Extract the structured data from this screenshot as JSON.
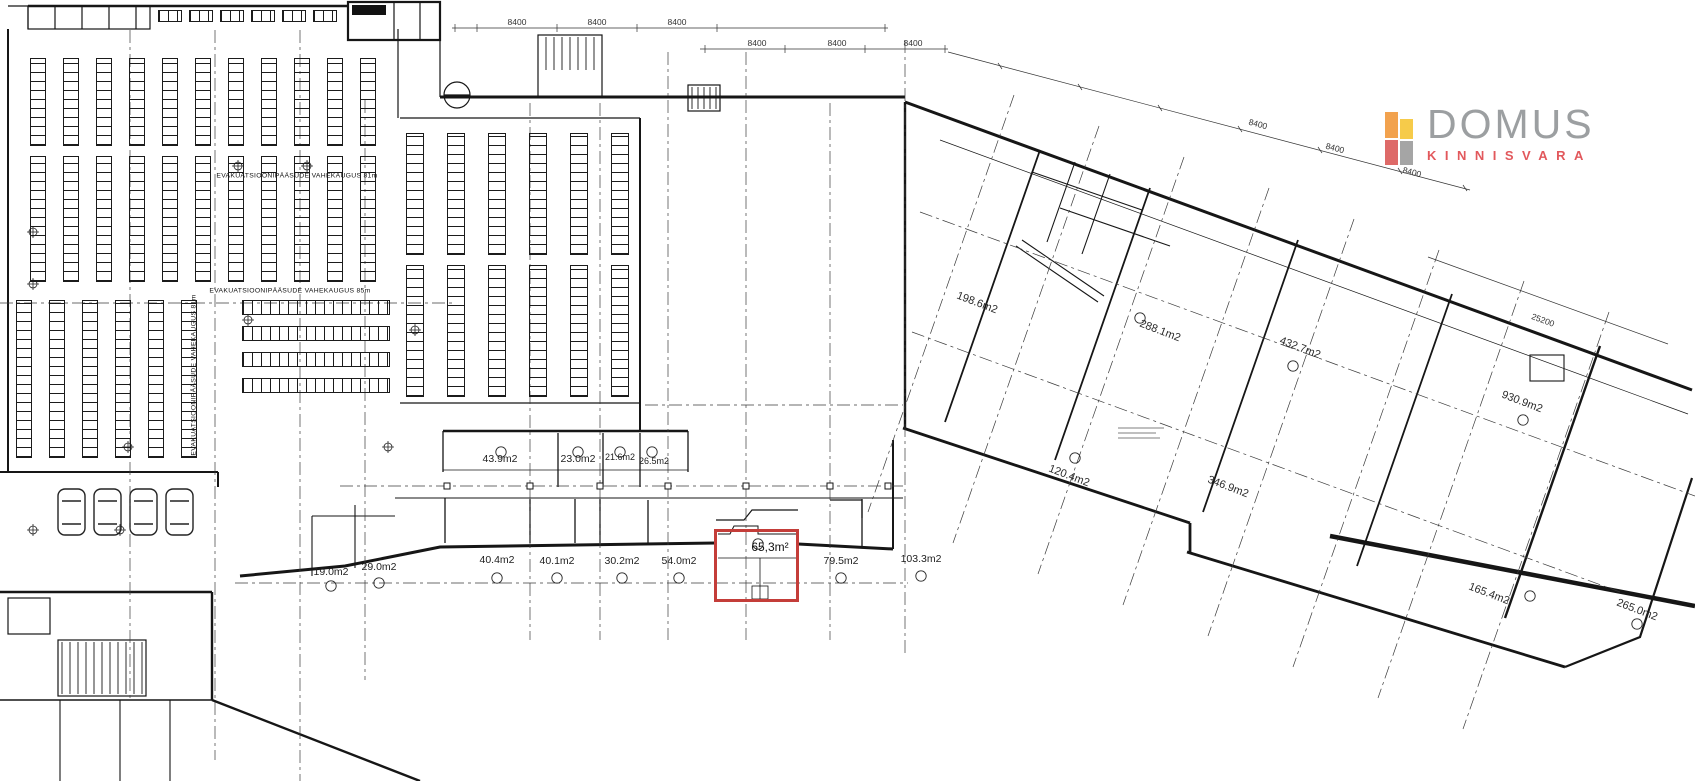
{
  "brand": {
    "name": "DOMUS",
    "tagline": "KINNISVARA",
    "name_color": "#9C9FA1",
    "tagline_color": "#E2585C",
    "mark_colors": {
      "top_left": "#F2A24E",
      "top_right": "#F6CB4A",
      "bottom_left": "#DE6A68",
      "bottom_right": "#A5A5A5"
    }
  },
  "plan": {
    "highlight_color": "#C43D39",
    "highlighted_area": "65,3m²",
    "areas": {
      "upper_row": [
        "43.9m2",
        "23.0m2",
        "21.6m2",
        "26.5m2"
      ],
      "lower_row": [
        "19.0m2",
        "29.0m2",
        "40.4m2",
        "40.1m2",
        "30.2m2",
        "54.0m2",
        "79.5m2",
        "103.3m2"
      ],
      "wing": [
        "198.6m2",
        "288.1m2",
        "432.7m2",
        "930.9m2",
        "120.4m2",
        "346.9m2",
        "165.4m2",
        "265.0m2"
      ]
    },
    "dimensions": {
      "top": [
        "8400",
        "8400",
        "8400",
        "8400",
        "8400",
        "8400"
      ],
      "wing": [
        "8400",
        "8400",
        "8400"
      ],
      "span": "25200"
    },
    "notes": {
      "evac_horizontal_1": "EVAKUATSIOONIPÄÄSUDE VAHEKAUGUS 81m",
      "evac_horizontal_2": "EVAKUATSIOONIPÄÄSUDE VAHEKAUGUS 85m",
      "evac_vertical": "EVAKUATSIOONIPÄÄSUDE VAHEKAUGUS 81m"
    }
  }
}
